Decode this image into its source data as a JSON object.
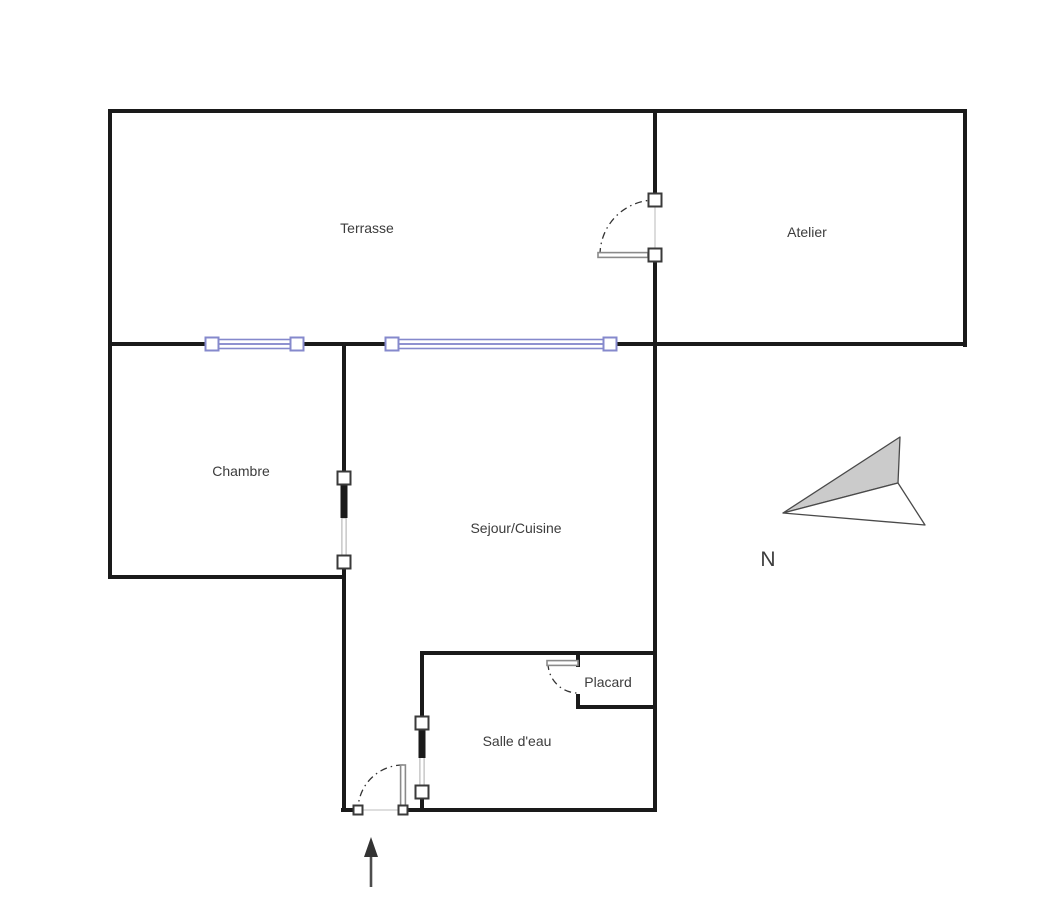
{
  "floor_plan": {
    "rooms": [
      {
        "id": "terrasse",
        "label": "Terrasse"
      },
      {
        "id": "atelier",
        "label": "Atelier"
      },
      {
        "id": "chambre",
        "label": "Chambre"
      },
      {
        "id": "sejour-cuisine",
        "label": "Sejour/Cuisine"
      },
      {
        "id": "salle-deau",
        "label": "Salle d'eau"
      },
      {
        "id": "placard",
        "label": "Placard"
      }
    ],
    "compass": {
      "label": "N"
    },
    "colors": {
      "wall": "#1a1a1a",
      "window": "#8589cc",
      "window_dark": "#6a6ec0",
      "door_frame": "#3a3a3a",
      "door_leaf": "#8a8a8a",
      "track": "#b4b4b4",
      "opening": "#c9c9c9",
      "arc": "#333333",
      "compass_fill": "#cbcbcb",
      "compass_stroke": "#4a4a4a",
      "arrow": "#4d4d4d",
      "text": "#3c3c3c"
    }
  }
}
